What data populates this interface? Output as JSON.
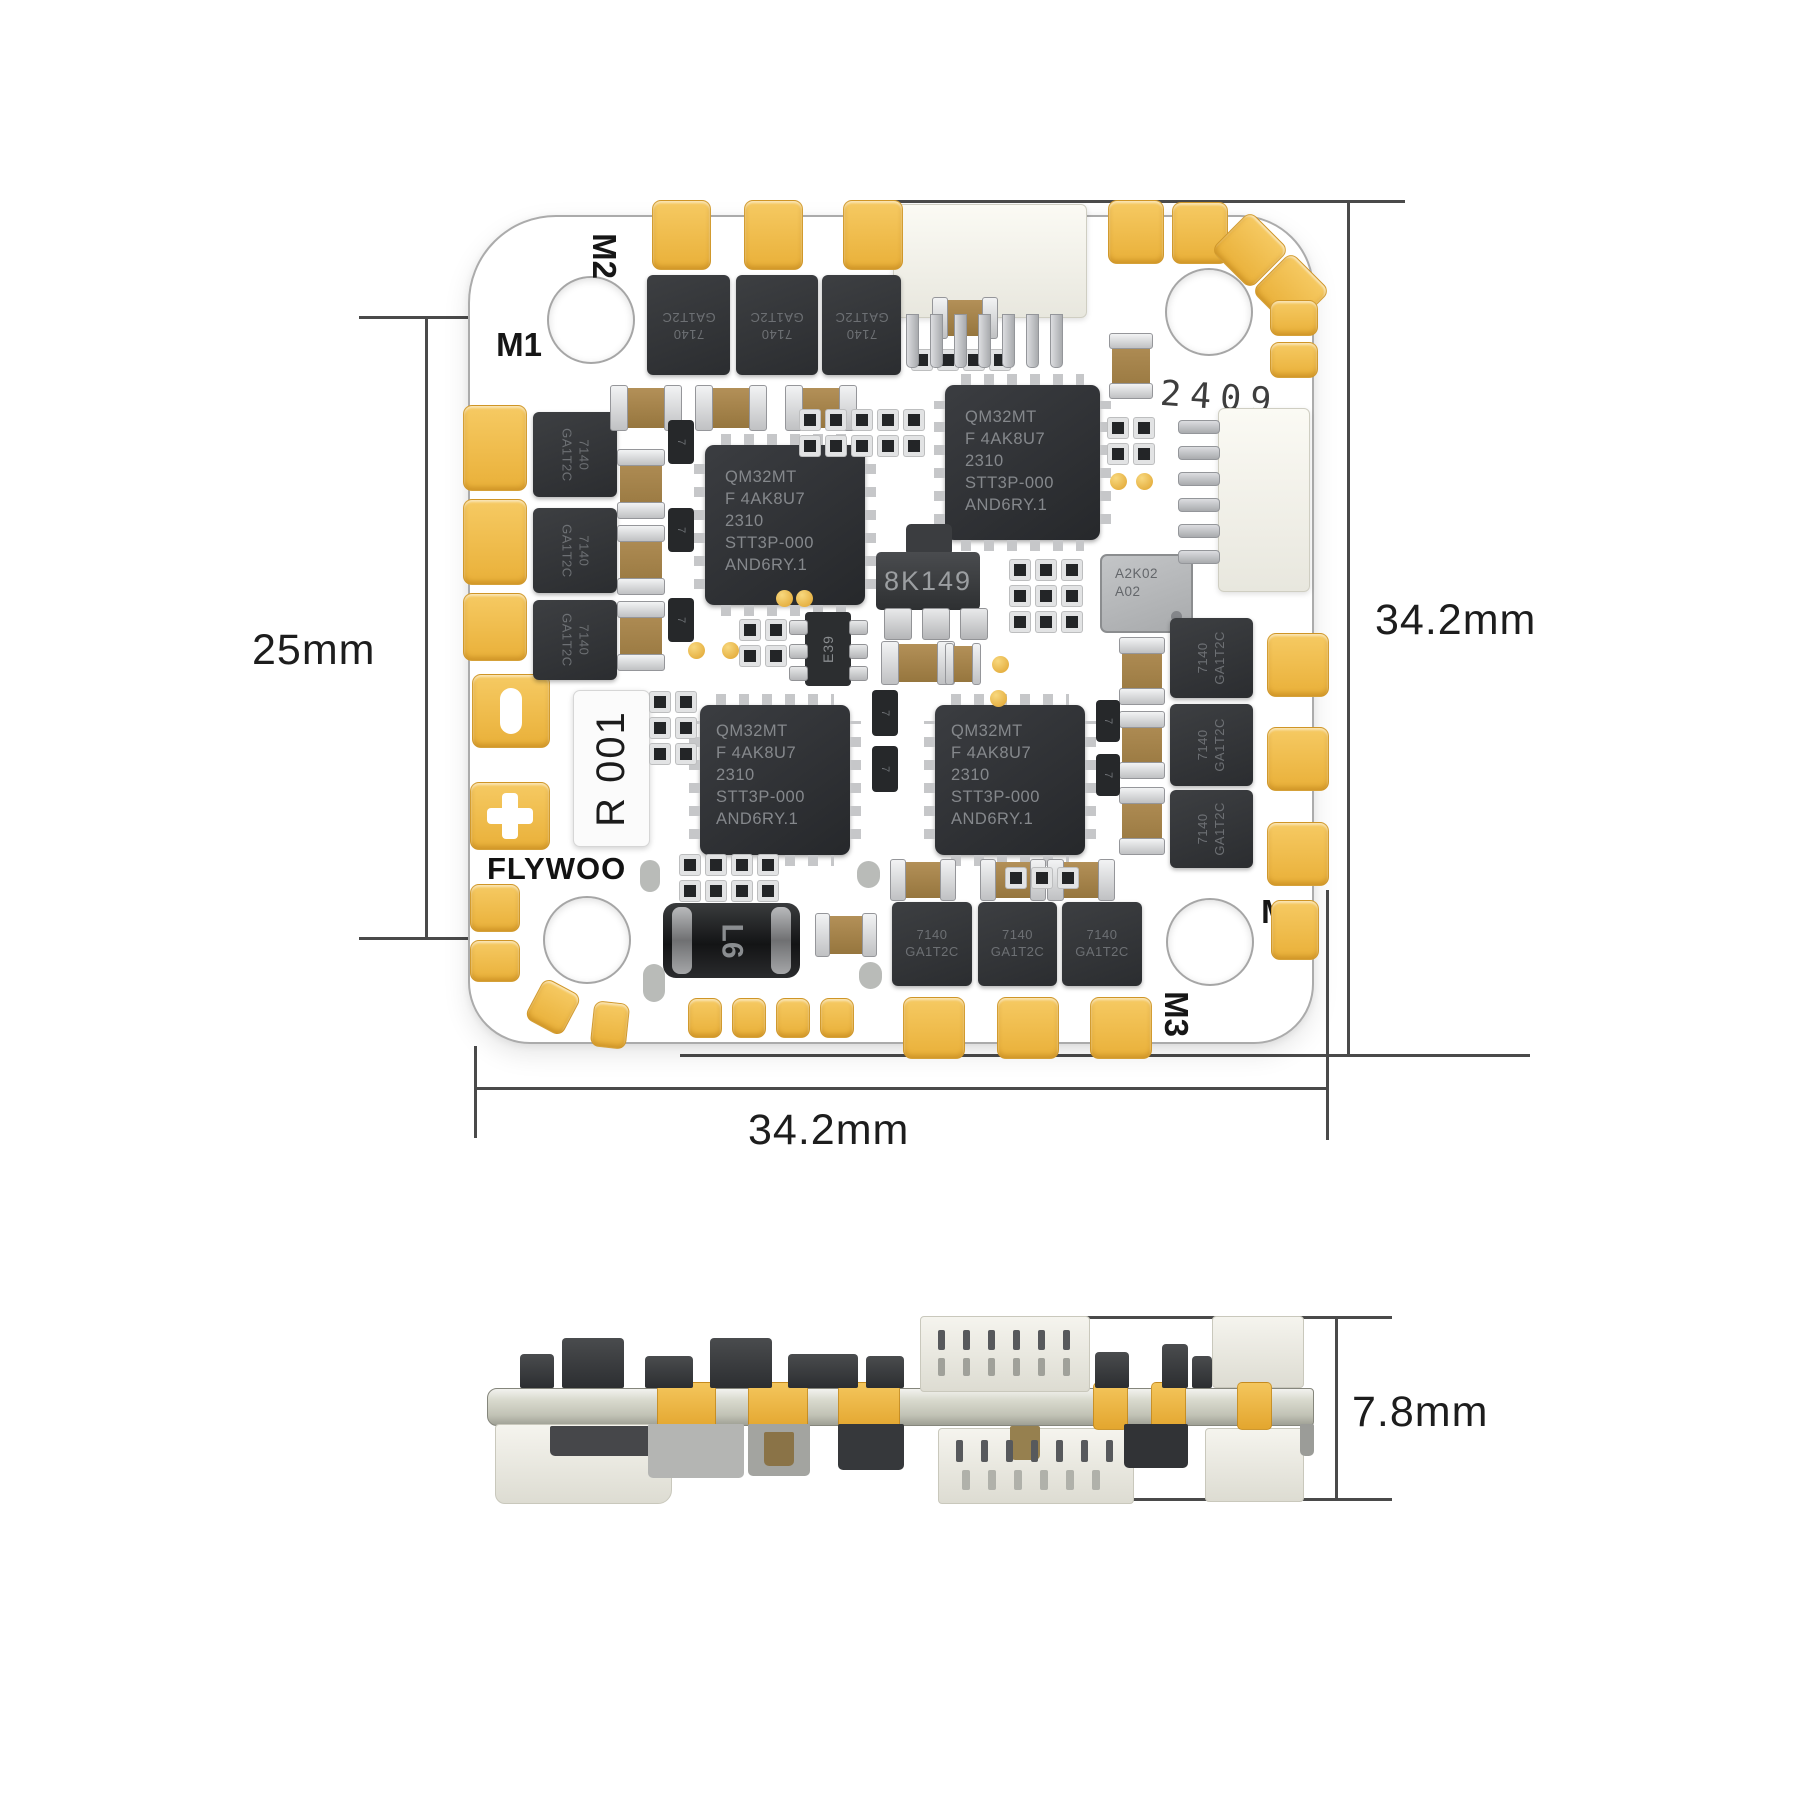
{
  "diagram": {
    "dimensions": {
      "hole_pitch": "25mm",
      "board_height": "34.2mm",
      "board_width": "34.2mm",
      "stack_height": "7.8mm"
    },
    "motor_labels": {
      "m1": "M1",
      "m2": "M2",
      "m3": "M3",
      "m4": "M4"
    },
    "silkscreen": {
      "brand": "FLYWOO",
      "batch_code": "2409",
      "serial_sticker": "R 001"
    },
    "components": {
      "mcu_lines": [
        "QM32MT",
        "F 4AK8U7",
        "2310",
        "STT3P-000",
        "AND6RY.1"
      ],
      "mosfet_lines": [
        "7140",
        "GA1T2C"
      ],
      "regulator_label": "8K149",
      "current_sensor_lines": [
        "A2K02",
        "A02"
      ],
      "inductor_label": "L6",
      "gate_driver_label": "E39",
      "diode_mark": "7"
    },
    "colors": {
      "pad_gold": "#F0BC4C",
      "board": "#FFFFFF",
      "chip": "#2F3134",
      "dimension_line": "#4A4A4A"
    }
  }
}
